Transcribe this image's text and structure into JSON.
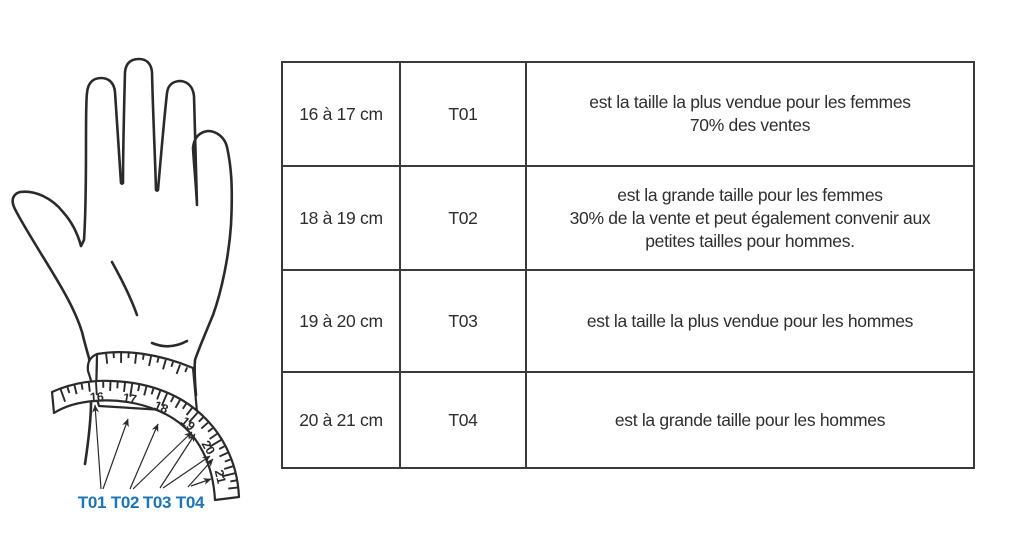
{
  "illustration": {
    "tape_numbers": [
      "16",
      "17",
      "18",
      "19",
      "20",
      "21"
    ],
    "size_labels": [
      {
        "label": "T01"
      },
      {
        "label": "T02"
      },
      {
        "label": "T03"
      },
      {
        "label": "T04"
      }
    ],
    "label_color": "#1b75bb"
  },
  "table": {
    "rows": [
      {
        "size": "16 à 17 cm",
        "code": "T01",
        "description": "est la taille la plus vendue pour les femmes\n70% des ventes"
      },
      {
        "size": "18 à 19 cm",
        "code": "T02",
        "description": "est la grande taille pour les femmes\n30% de la vente et peut également convenir aux\npetites tailles pour hommes."
      },
      {
        "size": "19 à 20 cm",
        "code": "T03",
        "description": "est la taille la plus vendue pour les hommes"
      },
      {
        "size": "20 à 21 cm",
        "code": "T04",
        "description": "est la grande taille pour les hommes"
      }
    ]
  }
}
